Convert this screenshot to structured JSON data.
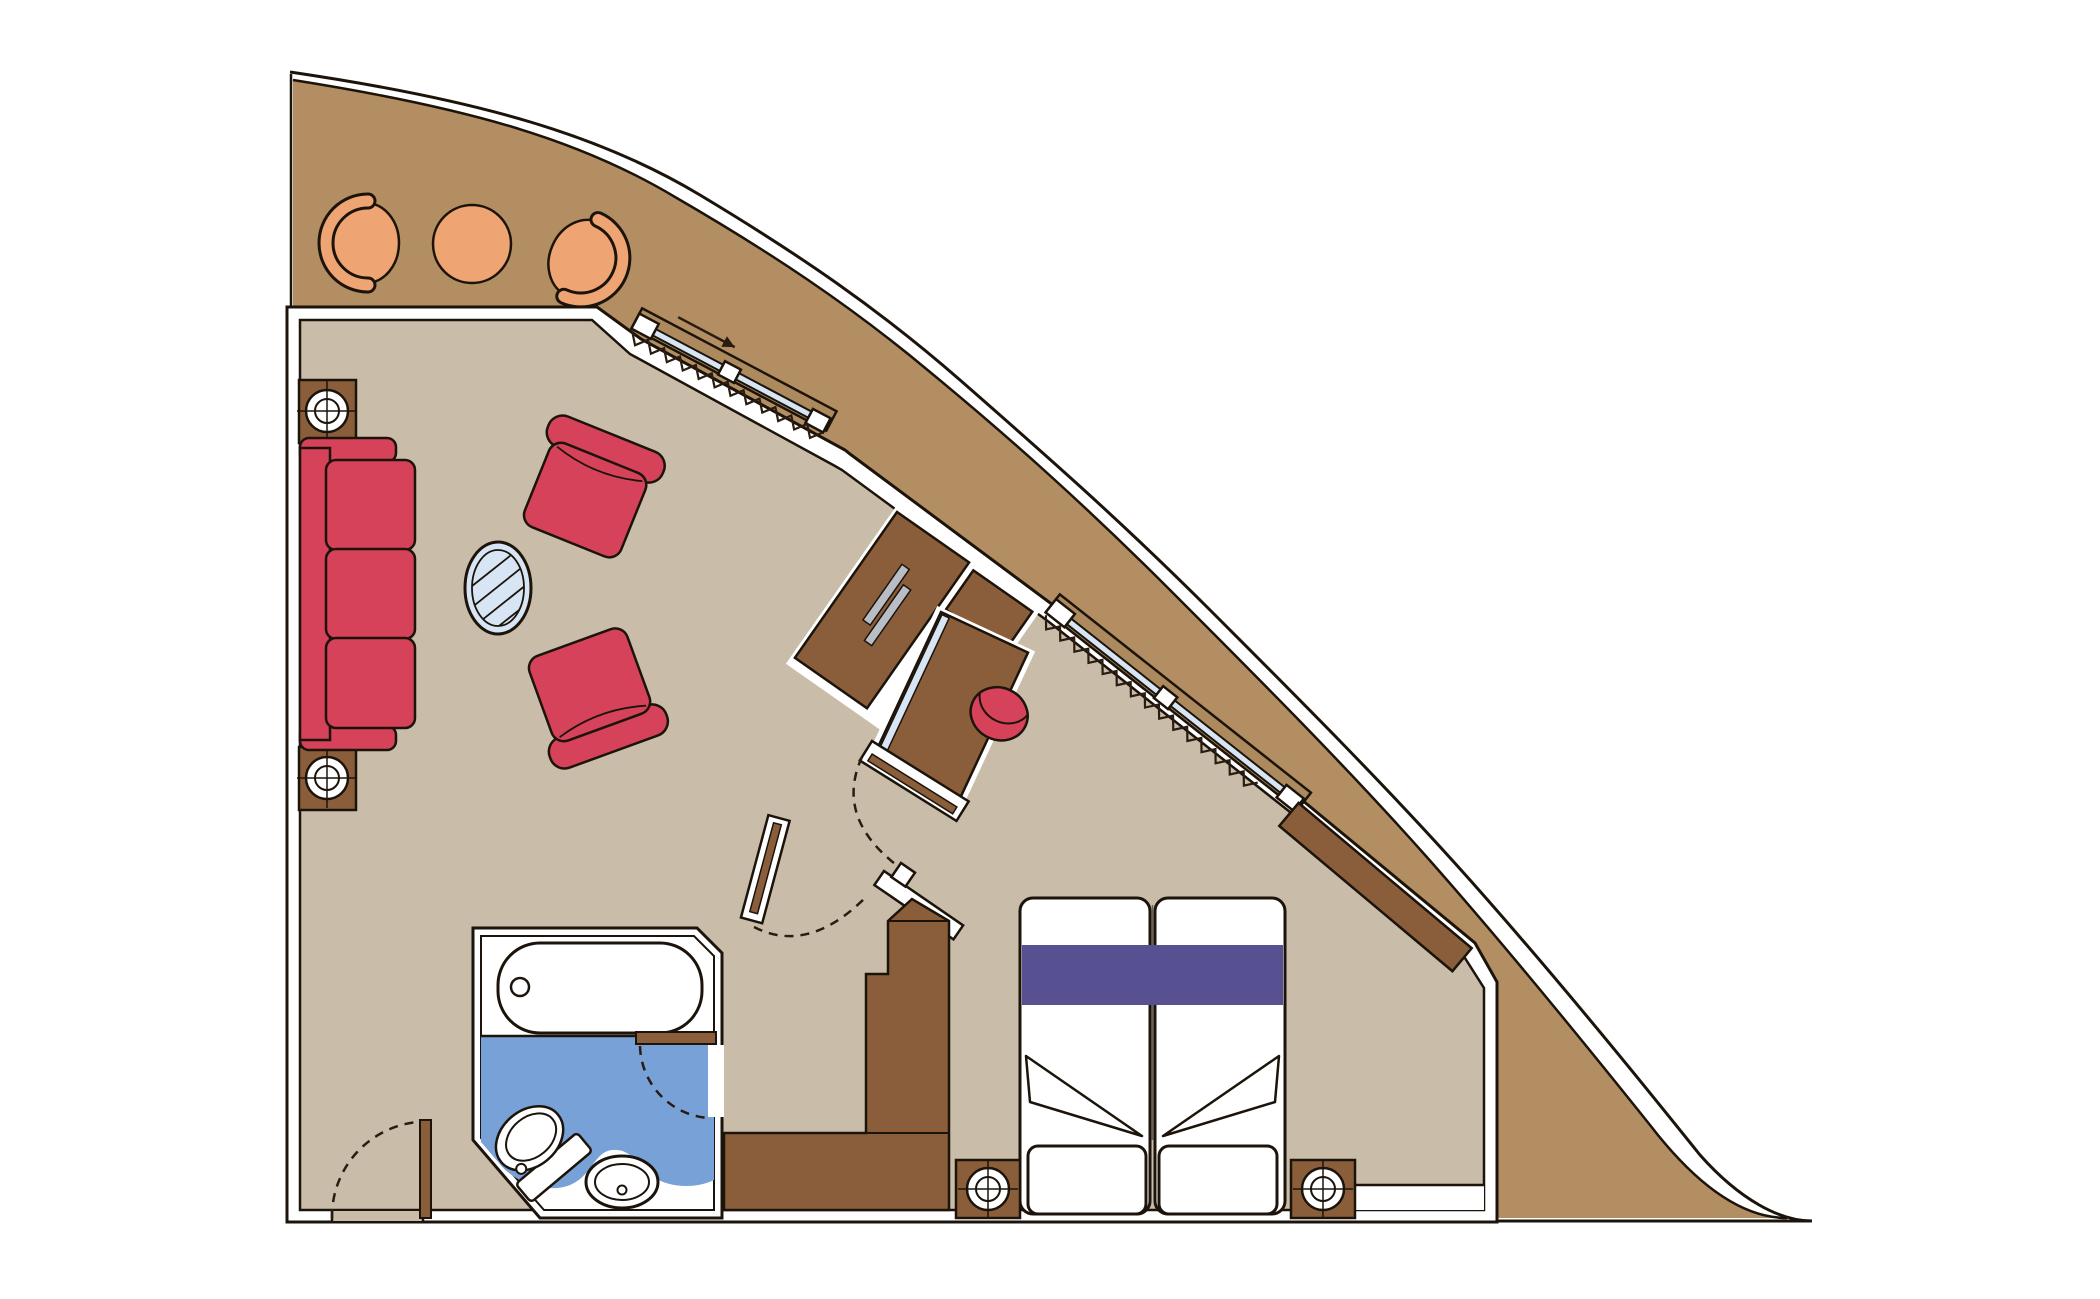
{
  "document": {
    "type": "floor-plan",
    "subject": "cruise-ship-suite-with-balcony"
  },
  "colors": {
    "background": "#ffffff",
    "hull": "#b28e62",
    "window_band": "#ad8a5e",
    "floor": "#c9bdaa",
    "bathroom_floor": "#78a1d7",
    "wall": "#ffffff",
    "outline": "#1c140b",
    "upholstery_red": "#d5425a",
    "balcony_orange": "#efa573",
    "wood_brown": "#8a5e3b",
    "bed_runner_purple": "#575091",
    "glass_blue": "#d7e5f4",
    "tv_gray": "#b9bdc6",
    "linen_white": "#ffffff"
  },
  "rooms": [
    {
      "name": "balcony"
    },
    {
      "name": "living-room"
    },
    {
      "name": "bedroom"
    },
    {
      "name": "bathroom"
    },
    {
      "name": "entry-corridor"
    }
  ],
  "furniture": [
    "balcony-tub-chair-left",
    "balcony-round-table",
    "balcony-tub-chair-right",
    "sofa",
    "armchair-upper",
    "armchair-lower",
    "oval-glass-table",
    "tv-cabinet",
    "tv",
    "desk",
    "desk-stool",
    "wardrobe-panel",
    "closet",
    "double-bed",
    "nightstand-left",
    "nightstand-right",
    "speaker-column-upper",
    "speaker-column-lower"
  ],
  "fixtures": [
    "bathtub",
    "toilet",
    "washbasin",
    "sliding-window-living",
    "sliding-window-bedroom",
    "curtain-living",
    "curtain-bedroom",
    "entry-door",
    "bathroom-door",
    "bedroom-door",
    "corridor-door",
    "slide-direction-arrow"
  ]
}
